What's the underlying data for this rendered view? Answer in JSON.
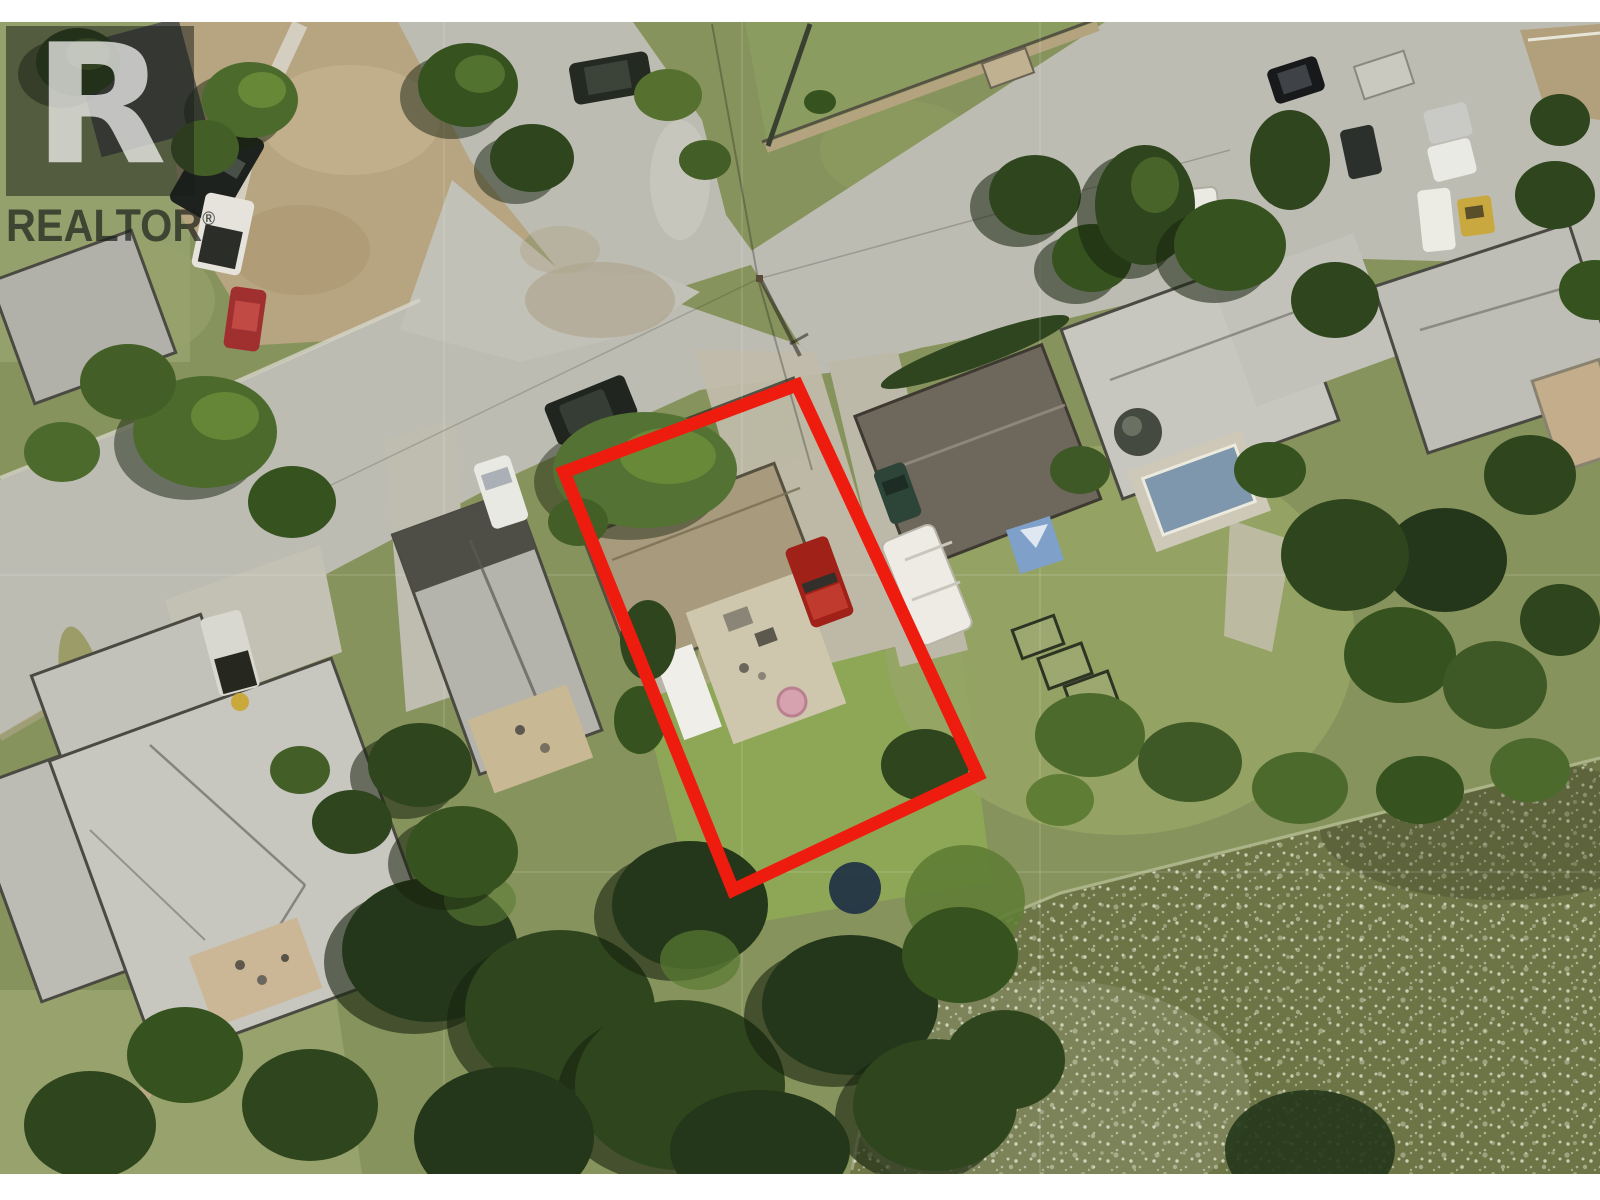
{
  "watermark": {
    "brand": "REALTOR",
    "registered_mark": "®",
    "logo_letter": "R"
  },
  "scene": {
    "type": "aerial-photo",
    "description": "Aerial view of riverfront residential street with subject lot outlined in red"
  },
  "colors": {
    "boundary_red": "#ee1c0e",
    "pavement": "#bdbcb2",
    "grass": "#87935c",
    "lawn_bright": "#8ea757",
    "water": "#6d7547",
    "roof_light": "#c7c6bf",
    "roof_tan": "#a89b7d",
    "roof_brown": "#6e675b",
    "truck_red": "#a02117",
    "pool_blue": "#7e97ac",
    "hot_tub_pink": "#d7a2b0"
  }
}
